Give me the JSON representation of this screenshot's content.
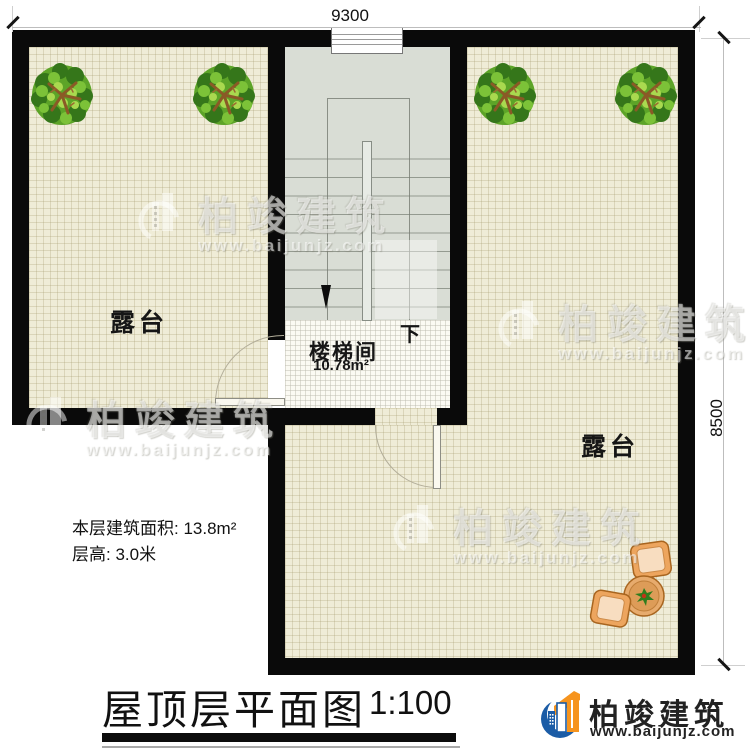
{
  "plan": {
    "title": "屋顶层平面图",
    "scale": "1:100",
    "dim_top": "9300",
    "dim_right": "8500",
    "left_terrace_label": "露台",
    "right_terrace_label": "露台",
    "stairwell_label": "楼梯间",
    "stairwell_area": "10.78m²",
    "down_label": "下",
    "info_line1": "本层建筑面积: 13.8m²",
    "info_line2": "层高: 3.0米"
  },
  "branding": {
    "logo_text": "柏竣建筑",
    "logo_url": "www.baijunjz.com"
  },
  "watermark": {
    "brand": "柏竣建筑",
    "url": "www.baijunjz.com"
  },
  "colors": {
    "wall": "#0a0a0a",
    "terrace_floor": "#efecd7",
    "stairwell_floor": "#d9ddd5",
    "logo_blue": "#1b5ca6",
    "logo_orange": "#f6941e"
  }
}
